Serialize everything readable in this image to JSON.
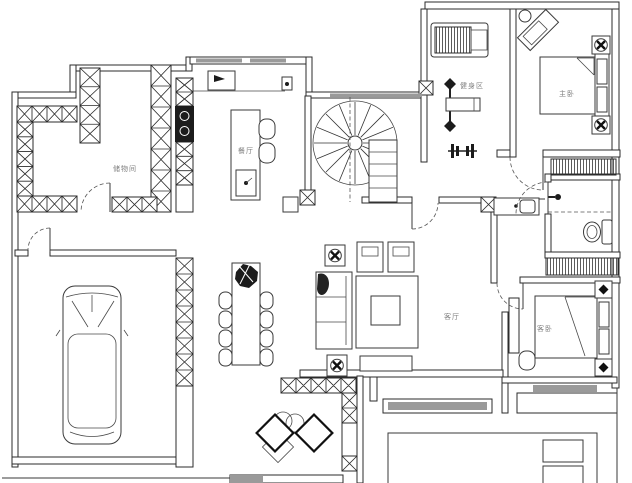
{
  "plan": {
    "type": "residential-floor-plan",
    "rooms": {
      "storage": {
        "label": "储物间"
      },
      "dining": {
        "label": "餐厅"
      },
      "gym": {
        "label": "健身区"
      },
      "master_bedroom": {
        "label": "主卧"
      },
      "living_room": {
        "label": "客厅"
      },
      "guest_bedroom": {
        "label": "客卧"
      }
    },
    "colors": {
      "wall_line": "#2b2b2b",
      "window_fill": "#9a9a9a",
      "label_text": "#7d7d7d",
      "background": "#ffffff"
    }
  }
}
